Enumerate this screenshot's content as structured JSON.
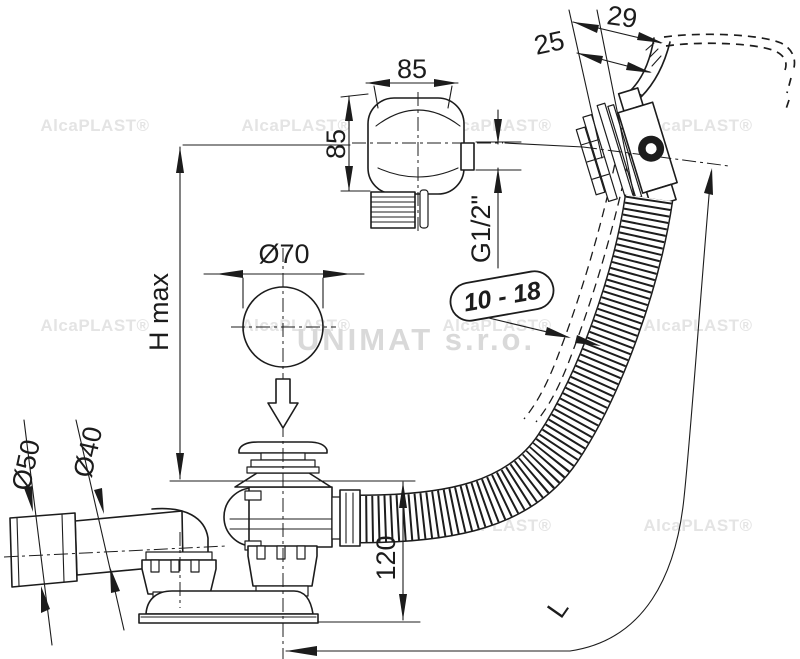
{
  "labels": {
    "knob_width": "85",
    "knob_height": "85",
    "thread_size": "G1/2\"",
    "rim_offset_outer": "29",
    "rim_offset_inner": "25",
    "wall_thickness_range": "10 - 18",
    "plug_diameter": "Ø70",
    "max_height": "H max",
    "outlet_diameter": "Ø50",
    "pipe_diameter": "Ø40",
    "underflow_depth": "120",
    "hose_length": "L"
  },
  "watermark": {
    "brand": "AlcaPLAST®",
    "distributor": "UNIMAT s.r.o."
  },
  "colors": {
    "line": "#1c1c1c",
    "watermark": "#e4e4e4",
    "background": "#ffffff"
  }
}
